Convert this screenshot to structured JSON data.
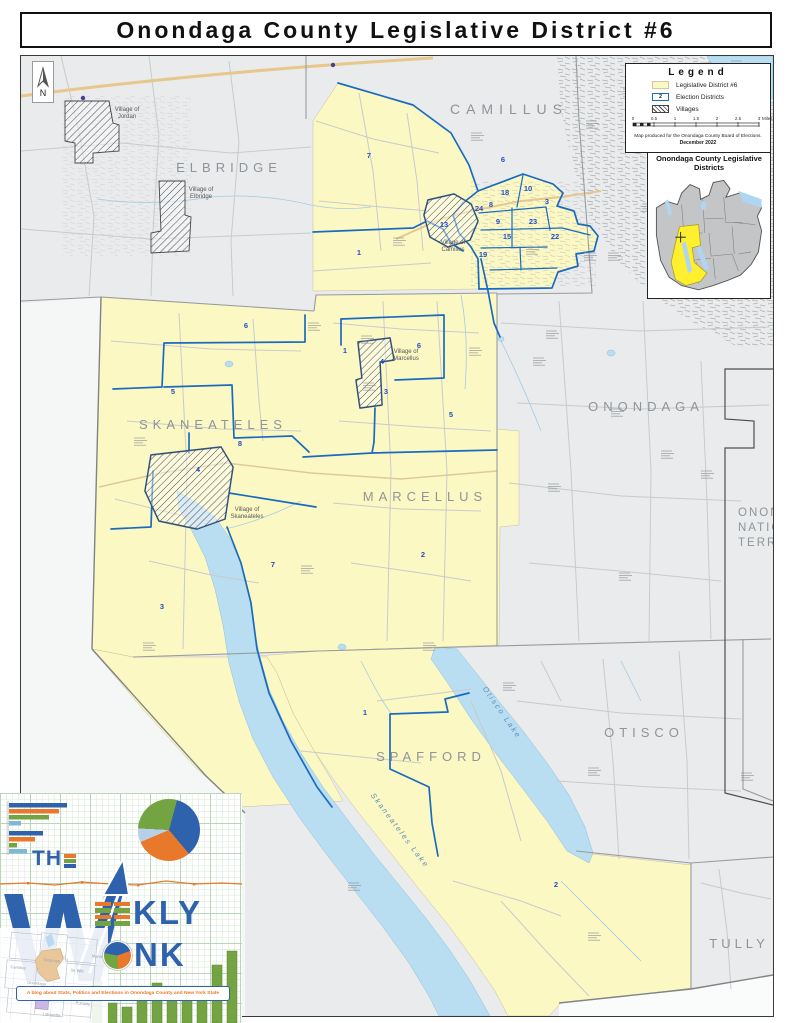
{
  "title": "Onondaga County Legislative District #6",
  "north_label": "N",
  "legend": {
    "title": "Legend",
    "items": [
      {
        "label": "Legislative District #6",
        "swatch": "district"
      },
      {
        "label": "Election Districts",
        "swatch": "ed",
        "symbol": "2"
      },
      {
        "label": "Villages",
        "swatch": "village"
      }
    ],
    "scale_ticks": [
      "0",
      "0.5",
      "1",
      "1.5",
      "2",
      "2.5",
      "3"
    ],
    "scale_unit": "Miles",
    "credit": "Map produced for the Onondaga County Board of Elections.",
    "credit_date": "December 2022"
  },
  "inset": {
    "title_line1": "Onondaga County Legislative",
    "title_line2": "Districts"
  },
  "map": {
    "towns": [
      {
        "name": "ELBRIDGE",
        "x": 228,
        "y": 171,
        "size": 13,
        "ls": 5
      },
      {
        "name": "CAMILLUS",
        "x": 508,
        "y": 113,
        "size": 14,
        "ls": 6
      },
      {
        "name": "SKANEATELES",
        "x": 212,
        "y": 428,
        "size": 13,
        "ls": 5
      },
      {
        "name": "MARCELLUS",
        "x": 424,
        "y": 500,
        "size": 13,
        "ls": 5
      },
      {
        "name": "ONONDAGA",
        "x": 645,
        "y": 410,
        "size": 13,
        "ls": 5
      },
      {
        "name": "OTISCO",
        "x": 643,
        "y": 736,
        "size": 13,
        "ls": 5
      },
      {
        "name": "SPAFFORD",
        "x": 430,
        "y": 760,
        "size": 13,
        "ls": 5
      },
      {
        "name": "TULLY",
        "x": 738,
        "y": 947,
        "size": 13,
        "ls": 4
      }
    ],
    "territory_lines": [
      "ONONDAGA",
      "NATION",
      "TERRITORY"
    ],
    "territory_pos": {
      "x": 737,
      "y": 515,
      "lh": 15
    },
    "villages": [
      {
        "line1": "Village of",
        "line2": "Jordan",
        "x": 126,
        "y": 110
      },
      {
        "line1": "Village of",
        "line2": "Elbridge",
        "x": 200,
        "y": 190
      },
      {
        "line1": "Village of",
        "line2": "Camillus",
        "x": 452,
        "y": 243
      },
      {
        "line1": "Village of",
        "line2": "Marcellus",
        "x": 405,
        "y": 352
      },
      {
        "line1": "Village of",
        "line2": "Skaneateles",
        "x": 246,
        "y": 510
      }
    ],
    "lakes": [
      {
        "name": "Otisco  Lake",
        "x": 499,
        "y": 713,
        "angle": 55
      },
      {
        "name": "Skaneateles  Lake",
        "x": 397,
        "y": 831,
        "angle": 53
      }
    ],
    "ed_numbers": [
      {
        "n": "7",
        "x": 368,
        "y": 157
      },
      {
        "n": "1",
        "x": 358,
        "y": 254
      },
      {
        "n": "6",
        "x": 502,
        "y": 161
      },
      {
        "n": "18",
        "x": 504,
        "y": 194
      },
      {
        "n": "10",
        "x": 527,
        "y": 190
      },
      {
        "n": "3",
        "x": 546,
        "y": 203
      },
      {
        "n": "24",
        "x": 478,
        "y": 210
      },
      {
        "n": "8",
        "x": 490,
        "y": 206
      },
      {
        "n": "9",
        "x": 497,
        "y": 223
      },
      {
        "n": "23",
        "x": 532,
        "y": 223
      },
      {
        "n": "15",
        "x": 506,
        "y": 238
      },
      {
        "n": "22",
        "x": 554,
        "y": 238
      },
      {
        "n": "19",
        "x": 482,
        "y": 256
      },
      {
        "n": "13",
        "x": 443,
        "y": 226
      },
      {
        "n": "1",
        "x": 344,
        "y": 352
      },
      {
        "n": "6",
        "x": 418,
        "y": 347
      },
      {
        "n": "4",
        "x": 381,
        "y": 363
      },
      {
        "n": "3",
        "x": 385,
        "y": 393
      },
      {
        "n": "5",
        "x": 450,
        "y": 416
      },
      {
        "n": "2",
        "x": 422,
        "y": 556
      },
      {
        "n": "6",
        "x": 245,
        "y": 327
      },
      {
        "n": "5",
        "x": 172,
        "y": 393
      },
      {
        "n": "8",
        "x": 239,
        "y": 445
      },
      {
        "n": "4",
        "x": 197,
        "y": 471
      },
      {
        "n": "7",
        "x": 272,
        "y": 566
      },
      {
        "n": "3",
        "x": 161,
        "y": 608
      },
      {
        "n": "1",
        "x": 364,
        "y": 714
      },
      {
        "n": "2",
        "x": 555,
        "y": 886
      }
    ]
  },
  "logo": {
    "the": "THE",
    "weekly": "WEEKLY",
    "wonk": "WONK",
    "tagline": "A blog about Stats, Politics and Elections in Onondaga County and New York State",
    "bar_heights": [
      42,
      20,
      16,
      24,
      40,
      34,
      32,
      36,
      58,
      72
    ],
    "mini_bars": [
      [
        58,
        50,
        40,
        12
      ],
      [
        34,
        26,
        8,
        18
      ]
    ],
    "mini_map_labels": [
      "Camillus",
      "Syracuse",
      "De Witt",
      "Manlius",
      "Onondaga",
      "LaFayette",
      "Pompey"
    ]
  }
}
